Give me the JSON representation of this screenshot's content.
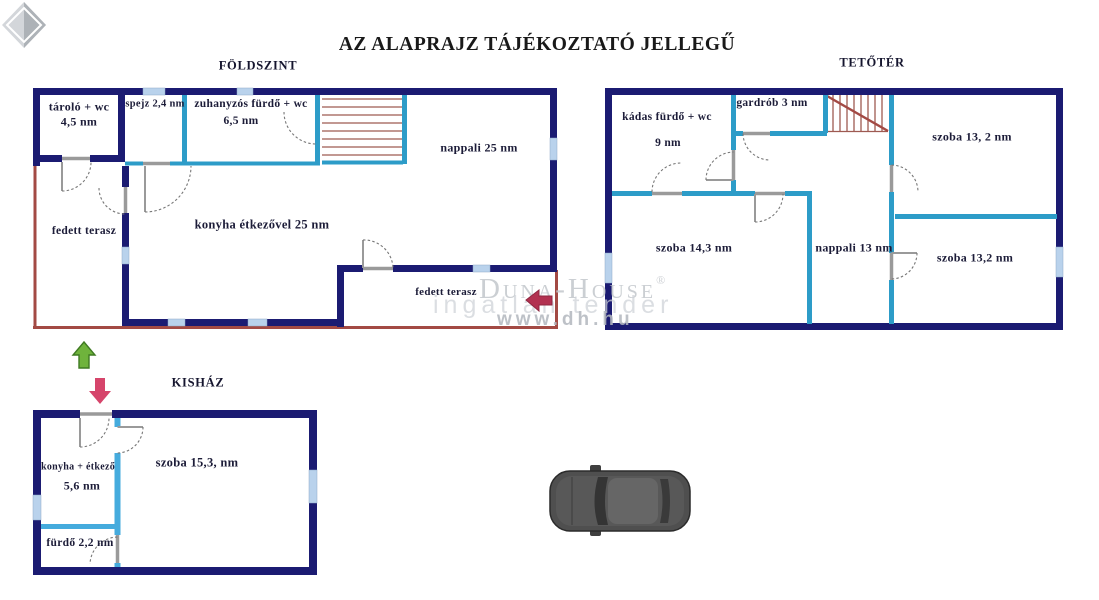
{
  "title": "AZ ALAPRAJZ TÁJÉKOZTATÓ JELLEGŰ",
  "sections": {
    "foldszint": {
      "title": "FÖLDSZINT",
      "rooms": {
        "tarolo_line1": "tároló + wc",
        "tarolo_line2": "4,5 nm",
        "spejz": "spejz 2,4 nm",
        "zuhanyzo_line1": "zuhanyzós fürdő + wc",
        "zuhanyzo_line2": "6,5 nm",
        "nappali": "nappali 25 nm",
        "konyha": "konyha étkezővel 25 nm",
        "terasz_bal": "fedett terasz",
        "terasz_also": "fedett terasz"
      }
    },
    "tetoter": {
      "title": "TETŐTÉR",
      "rooms": {
        "kadas_line1": "kádas fürdő + wc",
        "kadas_line2": "9 nm",
        "gardrob": "gardrób 3 nm",
        "szoba_jobb_felso": "szoba 13, 2 nm",
        "szoba_bal": "szoba 14,3 nm",
        "nappali": "nappali 13 nm",
        "szoba_jobb_also": "szoba 13,2 nm"
      }
    },
    "kishaz": {
      "title": "KISHÁZ",
      "rooms": {
        "konyha_line1": "konyha + étkező",
        "konyha_line2": "5,6 nm",
        "szoba": "szoba 15,3, nm",
        "furdo": "fürdő 2,2 nm"
      }
    }
  },
  "watermark": {
    "brand": "Duna-House",
    "reg": "®",
    "tagline": "ingatlan tender",
    "url": "www.dh.hu"
  },
  "colors": {
    "wall": "#1b1b72",
    "partition": "#2d9cc8",
    "partition_light": "#45abdd",
    "window": "#b9d2ec",
    "terrace": "#a34a44",
    "stairs": "#9e5a52",
    "door": "#9a9a9a",
    "arrow_green": "#6fb33c",
    "arrow_green_dark": "#3f7a22",
    "arrow_red": "#d6456b",
    "entry_arrow": "#b23150",
    "watermark_gray": "#c3c7cc",
    "car_body": "#4f4f4f"
  }
}
